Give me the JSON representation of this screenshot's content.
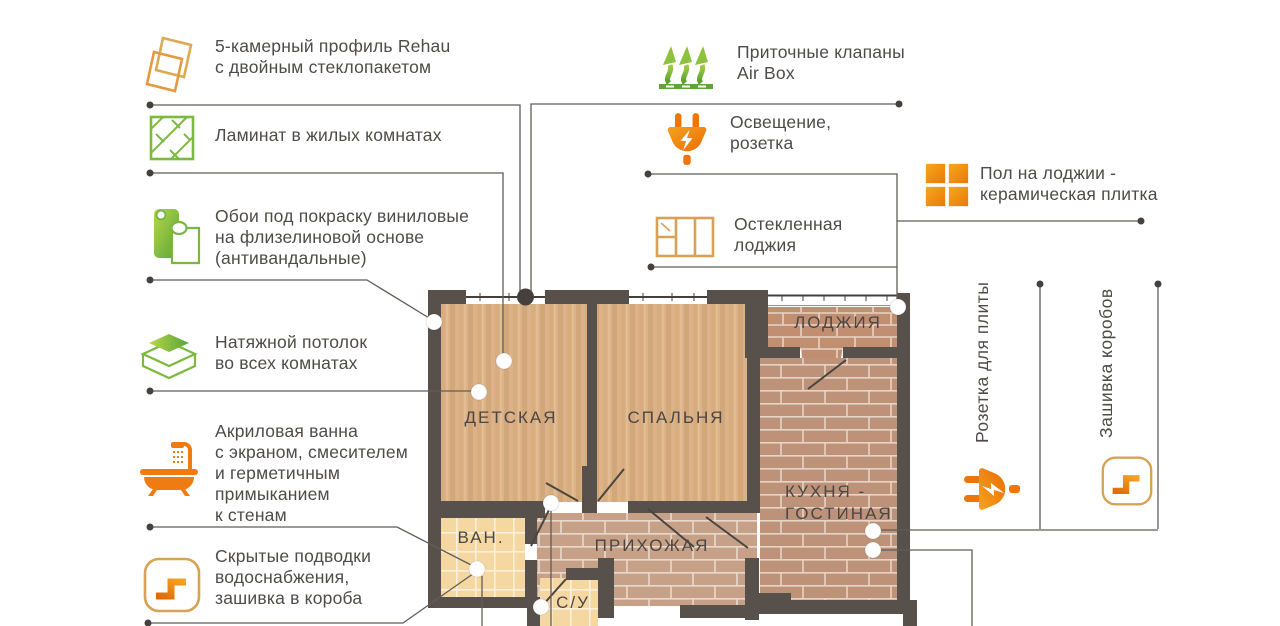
{
  "palette": {
    "green": "#76b73e",
    "orange": "#ee7c12",
    "wall": "#57504b",
    "text": "#4f4b48",
    "line": "#615d59"
  },
  "annotations": {
    "left": [
      {
        "icon": "window-profile",
        "lines": [
          "5-камерный профиль Rehau",
          "с двойным стеклопакетом"
        ]
      },
      {
        "icon": "laminate",
        "lines": [
          "Ламинат в жилых комнатах"
        ]
      },
      {
        "icon": "wallpaper",
        "lines": [
          "Обои под покраску виниловые",
          "на флизелиновой основе",
          "(антивандальные)"
        ]
      },
      {
        "icon": "stretch-ceiling",
        "lines": [
          "Натяжной потолок",
          "во всех комнатах"
        ]
      },
      {
        "icon": "bathtub",
        "lines": [
          "Акриловая ванна",
          "с экраном, смесителем",
          "и герметичным",
          "примыканием",
          "к стенам"
        ]
      },
      {
        "icon": "hidden-pipes",
        "lines": [
          "Скрытые подводки",
          "водоснабжения,",
          "зашивка в короба"
        ]
      }
    ],
    "top": [
      {
        "icon": "air-supply-valve",
        "lines": [
          "Приточные клапаны",
          "Air Box"
        ]
      },
      {
        "icon": "power-plug",
        "lines": [
          "Освещение,",
          "розетка"
        ]
      },
      {
        "icon": "glazed-loggia",
        "lines": [
          "Остекленная",
          "лоджия"
        ]
      },
      {
        "icon": "ceramic-tile",
        "lines": [
          "Пол на лоджии -",
          "керамическая плитка"
        ]
      }
    ],
    "right": [
      {
        "icon": "power-plug",
        "lines": [
          "Розетка для плиты"
        ]
      },
      {
        "icon": "hidden-pipes",
        "lines": [
          "Зашивка коробов"
        ]
      }
    ]
  },
  "floorplan": {
    "rooms": {
      "nursery": "ДЕТСКАЯ",
      "bedroom": "СПАЛЬНЯ",
      "loggia": "ЛОДЖИЯ",
      "kitchen": [
        "КУХНЯ -",
        "ГОСТИНАЯ"
      ],
      "bathroom": "ВАН.",
      "hallway": "ПРИХОЖАЯ",
      "wc": "С/У"
    }
  }
}
